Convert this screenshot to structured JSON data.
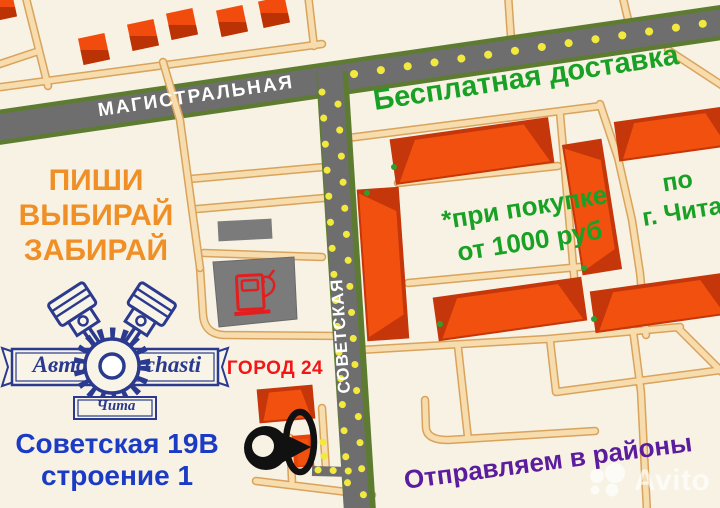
{
  "streets": {
    "horizontal": "МАГИСТРАЛЬНАЯ",
    "vertical": "СОВЕТСКАЯ"
  },
  "promo": {
    "free_delivery": "Бесплатная доставка",
    "purchase_note_line1": "*при покупке",
    "purchase_note_line2": "от 1000 руб",
    "city_note_line1": "по",
    "city_note_line2": "г. Чита",
    "cta_lines": [
      "ПИШИ",
      "ВЫБИРАЙ",
      "ЗАБИРАЙ"
    ],
    "districts": "Отправляем в районы"
  },
  "store": {
    "name": "ГОРОД 24",
    "address_line1": "Советская 19В",
    "address_line2": "строение 1"
  },
  "logo": {
    "word_left": "Авто",
    "word_right": "chasti",
    "city": "Чита"
  },
  "watermark": {
    "text": "Avito"
  },
  "colors": {
    "background": "#F7F2E3",
    "road_gray": "#6E6E6E",
    "road_green_border": "#5E7C31",
    "road_tan": "#F7DCAE",
    "dot_yellow": "#F2E93F",
    "building_orange": "#F1500E",
    "building_dark": "#C5360A",
    "promo_green": "#18A125",
    "cta_orange": "#EF8F26",
    "districts_purple": "#5B1D9E",
    "address_blue": "#1C3BC4",
    "store_red": "#F21616",
    "logo_navy": "#2B3A8F",
    "pin_black": "#111111",
    "gas_gray": "#7B7B7B",
    "pump_red": "#E31E1E"
  }
}
